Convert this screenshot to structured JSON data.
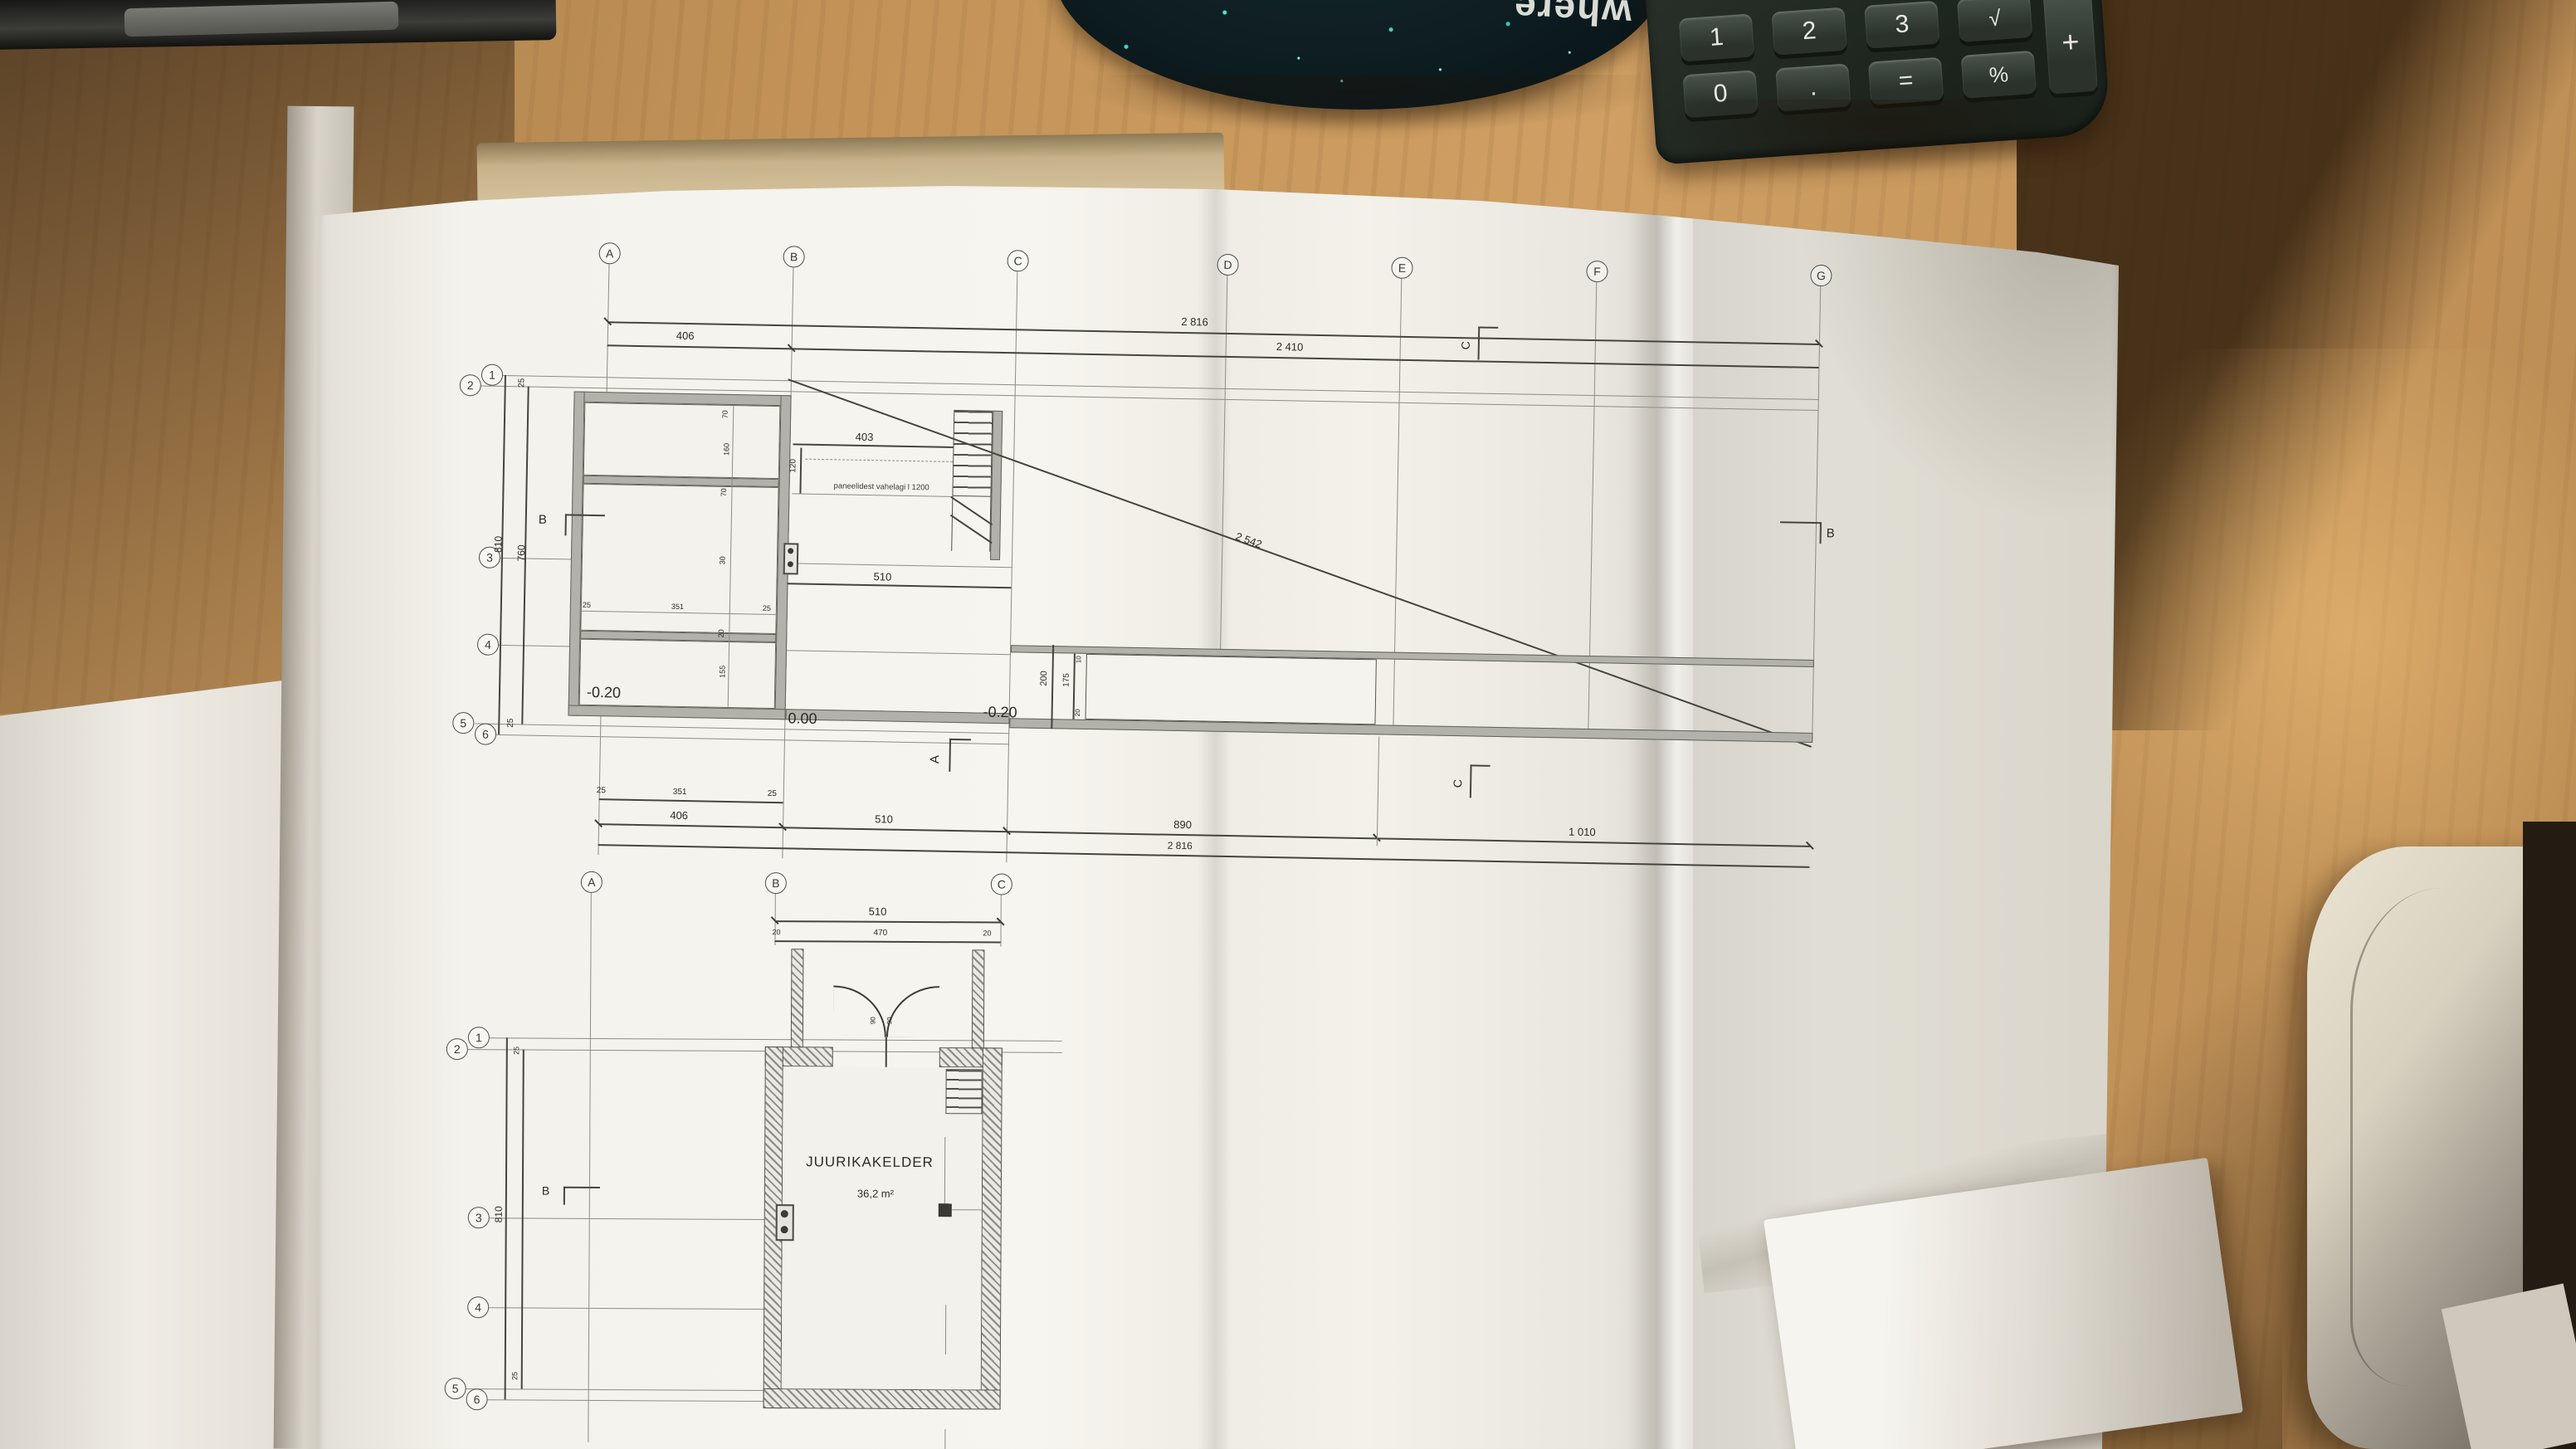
{
  "mousepad": {
    "text": "where"
  },
  "calculator": {
    "row1": [
      "1",
      "2",
      "3",
      "√"
    ],
    "plus": "+",
    "row2": [
      "0",
      ".",
      "=",
      "%"
    ]
  },
  "d": {
    "upper": {
      "cols": [
        "A",
        "B",
        "C",
        "D",
        "E",
        "F",
        "G"
      ],
      "rows": [
        "1",
        "2",
        "3",
        "4",
        "5",
        "6"
      ],
      "top_total": "2 816",
      "top_sub": "2 410",
      "ab": "406",
      "left_outer": "810",
      "left_inner": "760",
      "left_t": "25",
      "left_b": "25",
      "block_dims": [
        "70",
        "160",
        "70",
        "30",
        "20",
        "155"
      ],
      "sub": [
        "25",
        "351",
        "25"
      ],
      "d403": "403",
      "d120": "120",
      "note": "paneelidest vahelagi l 1200",
      "d510": "510",
      "diag": "2 542",
      "ramp_o": "200",
      "ramp_i": "175",
      "ramp_st": "10",
      "ramp_sb": "20",
      "lvl_l": "-0.20",
      "lvl_m": "0.00",
      "lvl_r": "-0.20",
      "bot": [
        "406",
        "510",
        "890",
        "1 010"
      ],
      "bot_total": "2 816",
      "sec_a": "A",
      "sec_b": "B",
      "sec_c": "C"
    },
    "lower": {
      "cols": [
        "A",
        "B",
        "C"
      ],
      "rows": [
        "1",
        "2",
        "3",
        "4",
        "5",
        "6"
      ],
      "d510": "510",
      "d470": "470",
      "d20l": "20",
      "d20r": "20",
      "d810": "810",
      "d25t": "25",
      "d25b": "25",
      "door": [
        "90",
        "90"
      ],
      "room": "JUURIKAKELDER",
      "area": "36,2 m²",
      "sec_b": "B"
    }
  }
}
